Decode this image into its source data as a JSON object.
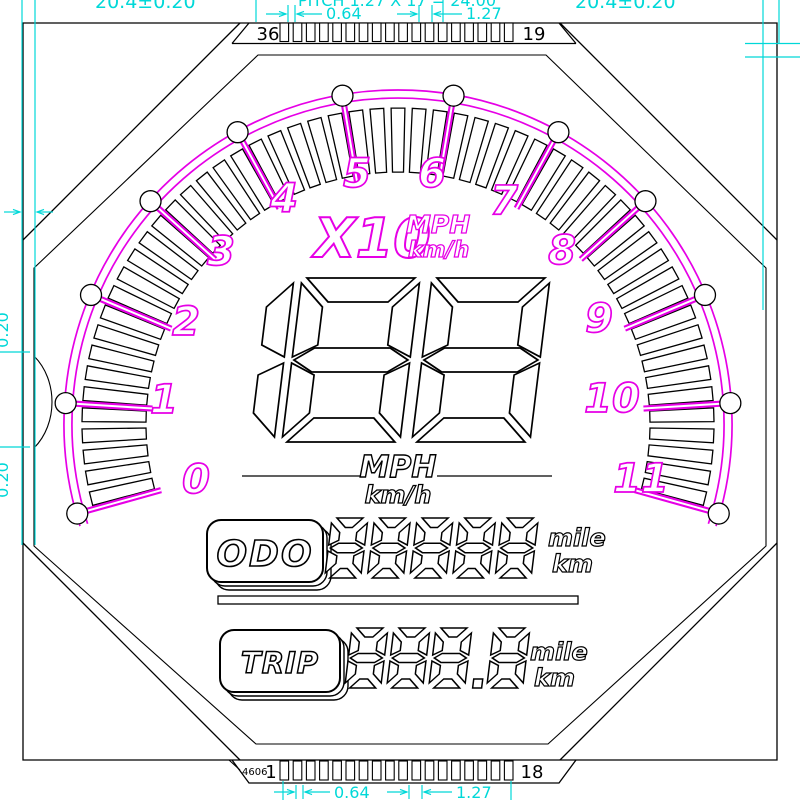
{
  "drawing": {
    "top_connector": {
      "start_label": "36",
      "end_label": "19",
      "pin_count": 18
    },
    "bottom_connector": {
      "start_label": "1",
      "end_label": "18",
      "pin_count": 18,
      "note": "4606"
    },
    "dimensions": {
      "top_pad_width": "0.64",
      "top_pitch": "1.27",
      "bottom_pad_width": "0.64",
      "bottom_pitch": "1.27",
      "clipped_top_left": "20.4±0.20",
      "clipped_top_center": "PITCH 1.27 X 17 = 24.00",
      "clipped_top_right": "20.4±0.20",
      "clipped_left_upper": "0.20",
      "clipped_left_lower": "0.20"
    },
    "dial": {
      "numbers": [
        "0",
        "1",
        "2",
        "3",
        "4",
        "5",
        "6",
        "7",
        "8",
        "9",
        "10",
        "11"
      ],
      "number_positions": [
        [
          196,
          479
        ],
        [
          164,
          399
        ],
        [
          186,
          321
        ],
        [
          221,
          251
        ],
        [
          284,
          198
        ],
        [
          357,
          173
        ],
        [
          432,
          173
        ],
        [
          504,
          200
        ],
        [
          562,
          250
        ],
        [
          599,
          318
        ],
        [
          612,
          398
        ],
        [
          641,
          478
        ]
      ],
      "minor_ticks_per_interval": 5,
      "multiplier": "X10",
      "unit_primary": "MPH",
      "unit_secondary": "km/h"
    },
    "speed_display": {
      "digits": "188",
      "unit_primary": "MPH",
      "unit_secondary": "km/h"
    },
    "odometer": {
      "label": "ODO",
      "digits": "88888",
      "unit_primary": "mile",
      "unit_secondary": "km"
    },
    "trip_meter": {
      "label": "TRIP",
      "digits": "888.8",
      "unit_primary": "mile",
      "unit_secondary": "km"
    },
    "colors": {
      "line": "#000000",
      "accent_magenta": "#e600e6",
      "dimension_cyan": "#00d8d8",
      "background": "#ffffff"
    }
  }
}
